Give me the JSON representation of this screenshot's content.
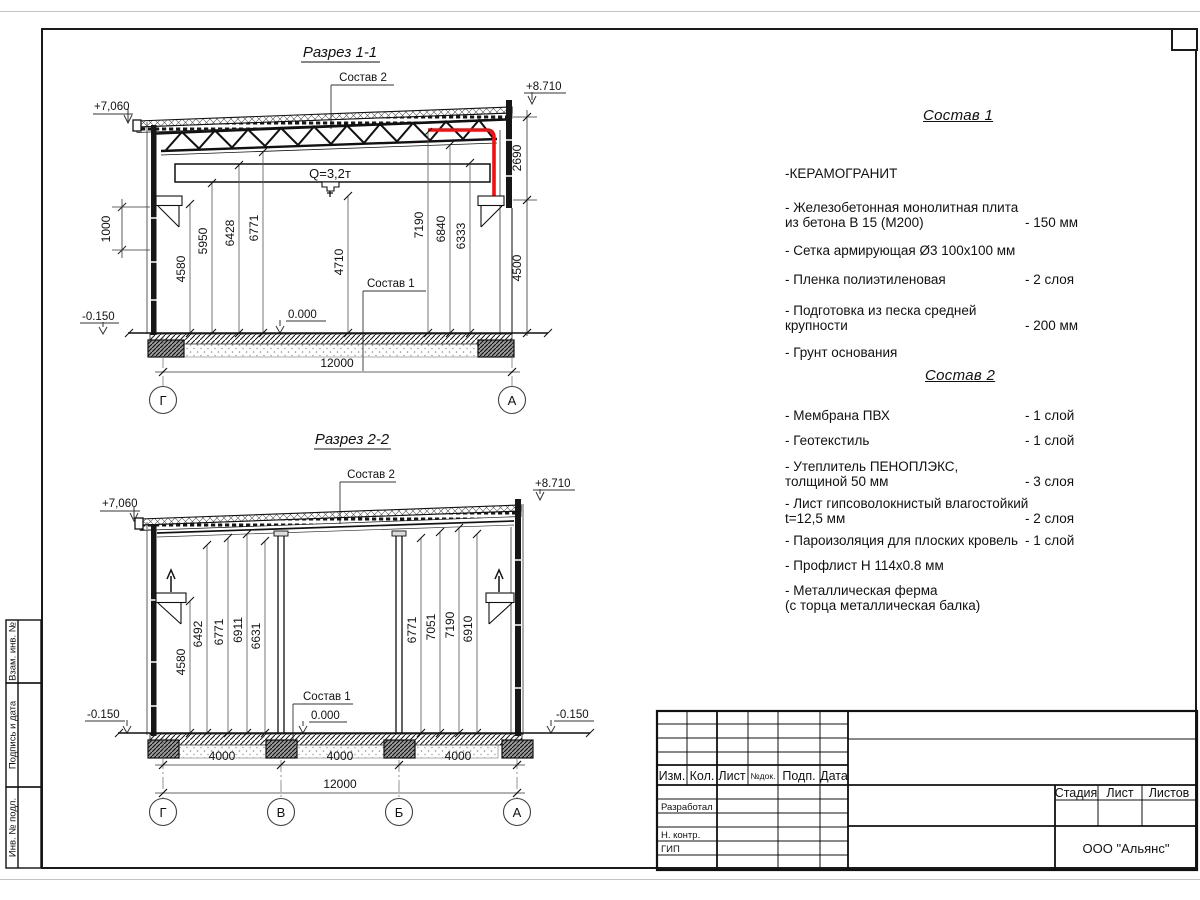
{
  "sheet": {
    "company": "ООО \"Альянс\"",
    "stamp": {
      "rev_headers": [
        "Изм.",
        "Кол.",
        "Лист",
        "№док.",
        "Подп.",
        "Дата"
      ],
      "role_rows": [
        "Разработал",
        "Н. контр.",
        "ГИП"
      ],
      "stage_header": "Стадия",
      "sheet_header": "Лист",
      "sheets_header": "Листов"
    },
    "margin_labels": {
      "top": "Взам. инв. №",
      "middle": "Подпись  и  дата",
      "bottom": "Инв. № подл."
    }
  },
  "section1": {
    "title": "Разрез 1-1",
    "sostav2_label": "Состав 2",
    "sostav1_label": "Состав 1",
    "elev_left": "+7,060",
    "elev_right": "+8.710",
    "elev_zero": "0.000",
    "elev_minus": "-0.150",
    "crane_label": "Q=3,2т",
    "dim_wall": "1000",
    "dims": [
      "4580",
      "5950",
      "6428",
      "6771",
      "4710",
      "7190",
      "6840",
      "6333"
    ],
    "dim_right_top": "2690",
    "dim_right_bottom": "4500",
    "dim_total": "12000",
    "grids": [
      "Г",
      "А"
    ]
  },
  "section2": {
    "title": "Разрез 2-2",
    "sostav2_label": "Состав 2",
    "sostav1_label": "Состав 1",
    "elev_left": "+7,060",
    "elev_right": "+8.710",
    "elev_zero": "0.000",
    "elev_minus_left": "-0.150",
    "elev_minus_right": "-0.150",
    "dims_left": [
      "4580",
      "6492",
      "6771",
      "6911",
      "6631"
    ],
    "dims_right": [
      "6771",
      "7051",
      "7190",
      "6910"
    ],
    "dims_bottom": [
      "4000",
      "4000",
      "4000"
    ],
    "dim_total": "12000",
    "grids": [
      "Г",
      "В",
      "Б",
      "А"
    ]
  },
  "sostav1": {
    "title": "Состав 1",
    "items": [
      {
        "name": "-КЕРАМОГРАНИТ",
        "value": ""
      },
      {
        "name": "- Железобетонная  монолитная плита\nиз бетона В 15 (М200)",
        "value": "- 150 мм"
      },
      {
        "name": "- Сетка армирующая Ø3 100х100 мм",
        "value": ""
      },
      {
        "name": "- Пленка полиэтиленовая",
        "value": "-  2 слоя"
      },
      {
        "name": "- Подготовка из песка средней\nкрупности",
        "value": "- 200 мм"
      },
      {
        "name": "- Грунт основания",
        "value": ""
      }
    ]
  },
  "sostav2": {
    "title": "Состав 2",
    "items": [
      {
        "name": "- Мембрана ПВХ",
        "value": "- 1 слой"
      },
      {
        "name": "- Геотекстиль",
        "value": "- 1 слой"
      },
      {
        "name": "- Утеплитель ПЕНОПЛЭКС,\nтолщиной 50 мм",
        "value": "- 3 слоя"
      },
      {
        "name": "- Лист гипсоволокнистый влагостойкий\nt=12,5 мм",
        "value": "- 2 слоя"
      },
      {
        "name": "- Пароизоляция для плоских кровель",
        "value": "- 1 слой"
      },
      {
        "name": "- Профлист Н 114х0.8 мм",
        "value": ""
      },
      {
        "name": "- Металлическая ферма\n(с торца металлическая балка)",
        "value": ""
      }
    ]
  }
}
